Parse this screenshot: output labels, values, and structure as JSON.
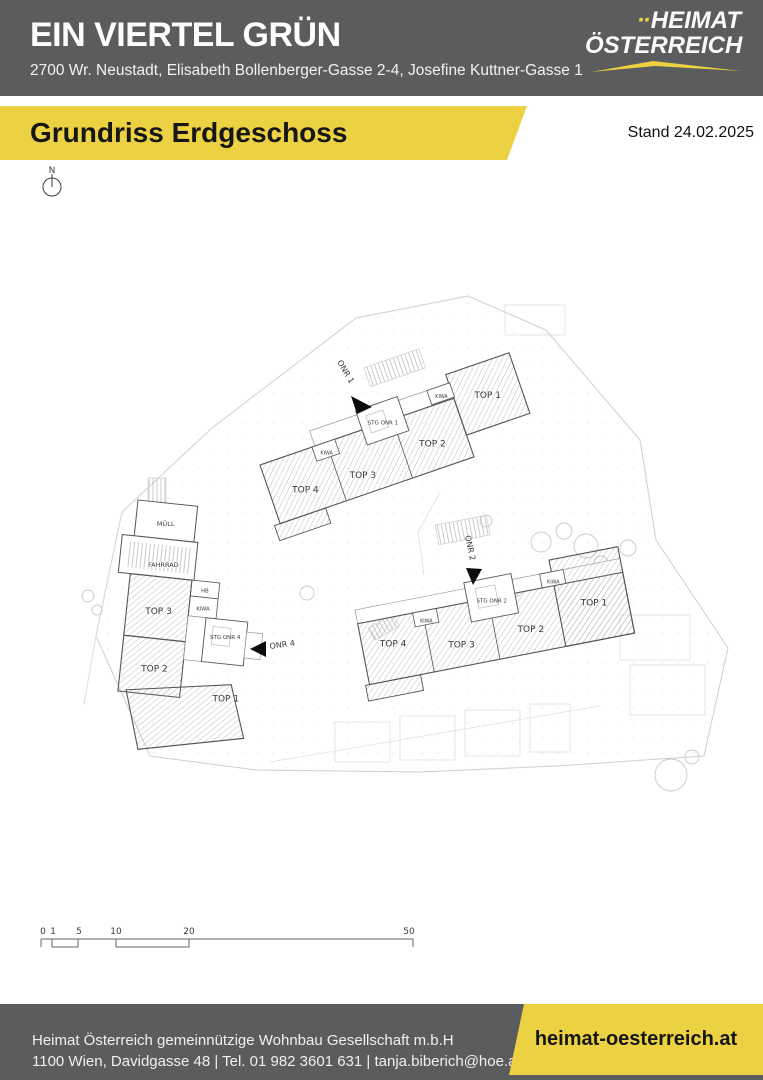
{
  "header": {
    "title": "EIN VIERTEL GRÜN",
    "address": "2700 Wr. Neustadt, Elisabeth Bollenberger-Gasse 2-4, Josefine Kuttner-Gasse 1",
    "logo": {
      "dots": "··",
      "line1": "HEIMAT",
      "line2": "ÖSTERREICH"
    }
  },
  "banner": {
    "title": "Grundriss Erdgeschoss",
    "stand": "Stand 24.02.2025"
  },
  "plan": {
    "compass": "N",
    "buildings": {
      "onr1": {
        "entrance": "ONR 1",
        "stair": "STG ONR 1",
        "kiwa_left": "KIWA",
        "kiwa_right": "KIWA",
        "units": {
          "top1": "TOP 1",
          "top2": "TOP 2",
          "top3": "TOP 3",
          "top4": "TOP 4"
        }
      },
      "onr2": {
        "entrance": "ONR 2",
        "stair": "STG ONR 2",
        "kiwa_left": "KIWA",
        "kiwa_right": "KIWA",
        "units": {
          "top1": "TOP 1",
          "top2": "TOP 2",
          "top3": "TOP 3",
          "top4": "TOP 4"
        }
      },
      "onr4": {
        "entrance": "ONR 4",
        "stair": "STG ONR 4",
        "rooms": {
          "muell": "MÜLL",
          "fahrrad": "FAHRRAD",
          "hb": "HB",
          "kiwa": "KIWA"
        },
        "units": {
          "top1": "TOP 1",
          "top2": "TOP 2",
          "top3": "TOP 3"
        }
      }
    },
    "scalebar": [
      "0",
      "1",
      "5",
      "10",
      "20",
      "50"
    ]
  },
  "footer": {
    "line1": "Heimat Österreich gemeinnützige Wohnbau Gesellschaft m.b.H",
    "line2": "1100 Wien, Davidgasse 48 | Tel. 01 982 3601 631 | tanja.biberich@hoe.at",
    "website": "heimat-oesterreich.at"
  },
  "colors": {
    "accent_yellow": "#ECD243",
    "band_gray": "#5B5C5E"
  }
}
